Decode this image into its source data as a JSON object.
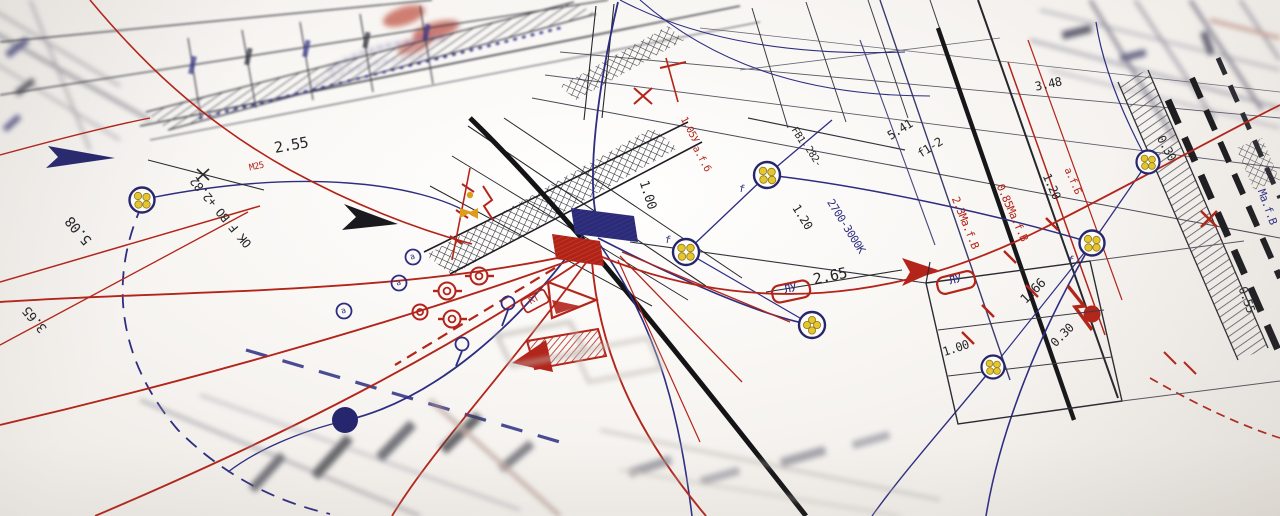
{
  "scene": {
    "title": "electrical installation blueprint photo",
    "type": "technical-drawing-photograph"
  },
  "palette": {
    "paper": "#faf8f5",
    "ink": "#26262a",
    "red": "#b3241a",
    "navy": "#2d2d82",
    "yellow_dot": "#e6c62e",
    "orange": "#e09b18",
    "gray_line": "#6a6a72"
  },
  "symbols": {
    "circle_cluster": "cable-group-with-yellow-cores",
    "circled_letter": "а",
    "lightning": "fault-bolt",
    "hatched_band": "cable-tray-run"
  },
  "annotations": [
    {
      "text": "2.55",
      "x": 292,
      "y": 150,
      "rot": -10,
      "color": "ink",
      "size": 15,
      "name": "dimension-label"
    },
    {
      "text": "М25",
      "x": 257,
      "y": 169,
      "rot": -12,
      "color": "red",
      "size": 9,
      "name": "conduit-label"
    },
    {
      "text": "OK F BO +2.82",
      "x": 224,
      "y": 210,
      "rot": -130,
      "color": "ink",
      "size": 12,
      "name": "level-label"
    },
    {
      "text": "5.08",
      "x": 82,
      "y": 228,
      "rot": -130,
      "color": "ink",
      "size": 14,
      "name": "dimension-label"
    },
    {
      "text": "3.65",
      "x": 38,
      "y": 317,
      "rot": -130,
      "color": "ink",
      "size": 13,
      "name": "dimension-label"
    },
    {
      "text": "1.05У",
      "x": 687,
      "y": 131,
      "rot": 62,
      "color": "red",
      "size": 10,
      "name": "circuit-label"
    },
    {
      "text": "а.f.б",
      "x": 699,
      "y": 160,
      "rot": 62,
      "color": "red",
      "size": 10,
      "name": "circuit-label"
    },
    {
      "text": "1.00",
      "x": 644,
      "y": 196,
      "rot": 72,
      "color": "ink",
      "size": 13,
      "name": "dimension-label"
    },
    {
      "text": "f",
      "x": 741,
      "y": 192,
      "rot": 10,
      "color": "navy",
      "size": 10,
      "name": "phase-label"
    },
    {
      "text": "f",
      "x": 667,
      "y": 243,
      "rot": 10,
      "color": "navy",
      "size": 10,
      "name": "phase-label"
    },
    {
      "text": "f",
      "x": 1070,
      "y": 263,
      "rot": 10,
      "color": "navy",
      "size": 10,
      "name": "phase-label"
    },
    {
      "text": "FB1-",
      "x": 797,
      "y": 139,
      "rot": 58,
      "color": "ink",
      "size": 10,
      "name": "device-label"
    },
    {
      "text": "282-",
      "x": 811,
      "y": 158,
      "rot": 58,
      "color": "ink",
      "size": 10,
      "name": "device-label"
    },
    {
      "text": "1.20",
      "x": 799,
      "y": 219,
      "rot": 58,
      "color": "ink",
      "size": 12,
      "name": "dimension-label"
    },
    {
      "text": "2700-3000K",
      "x": 843,
      "y": 228,
      "rot": 58,
      "color": "navy",
      "size": 11,
      "name": "lamp-spec-label"
    },
    {
      "text": "2.65",
      "x": 831,
      "y": 281,
      "rot": -12,
      "color": "ink",
      "size": 15,
      "name": "dimension-label"
    },
    {
      "text": "ЛУ",
      "x": 791,
      "y": 292,
      "rot": -12,
      "color": "navy",
      "size": 11,
      "name": "junction-tag"
    },
    {
      "text": "ЛУ",
      "x": 956,
      "y": 283,
      "rot": -14,
      "color": "navy",
      "size": 11,
      "name": "junction-tag"
    },
    {
      "text": "5.41",
      "x": 902,
      "y": 133,
      "rot": -32,
      "color": "ink",
      "size": 12,
      "name": "dimension-label"
    },
    {
      "text": "f1-2",
      "x": 932,
      "y": 151,
      "rot": -32,
      "color": "ink",
      "size": 12,
      "name": "phase-label"
    },
    {
      "text": "2.3Ма.f.В",
      "x": 962,
      "y": 224,
      "rot": 68,
      "color": "red",
      "size": 11,
      "name": "cable-spec-label"
    },
    {
      "text": "0.85Ма.f.В",
      "x": 1009,
      "y": 214,
      "rot": 66,
      "color": "red",
      "size": 11,
      "name": "cable-spec-label"
    },
    {
      "text": "1.20",
      "x": 1048,
      "y": 188,
      "rot": 66,
      "color": "ink",
      "size": 12,
      "name": "dimension-label"
    },
    {
      "text": "а.f.Б",
      "x": 1070,
      "y": 182,
      "rot": 66,
      "color": "red",
      "size": 10,
      "name": "cable-spec-label"
    },
    {
      "text": "3.48",
      "x": 1049,
      "y": 88,
      "rot": -12,
      "color": "ink",
      "size": 12,
      "name": "dimension-label"
    },
    {
      "text": "0.30",
      "x": 1163,
      "y": 150,
      "rot": 62,
      "color": "ink",
      "size": 12,
      "name": "dimension-label"
    },
    {
      "text": "0.55",
      "x": 1243,
      "y": 301,
      "rot": 70,
      "color": "ink",
      "size": 12,
      "name": "dimension-label"
    },
    {
      "text": "Ма.f.В",
      "x": 1264,
      "y": 208,
      "rot": 70,
      "color": "navy",
      "size": 11,
      "name": "cable-spec-label"
    },
    {
      "text": "1.66",
      "x": 1036,
      "y": 294,
      "rot": -45,
      "color": "ink",
      "size": 13,
      "name": "dimension-label"
    },
    {
      "text": "0.30",
      "x": 1065,
      "y": 338,
      "rot": -45,
      "color": "ink",
      "size": 12,
      "name": "dimension-label"
    },
    {
      "text": "1.00",
      "x": 957,
      "y": 352,
      "rot": -18,
      "color": "ink",
      "size": 12,
      "name": "dimension-label"
    },
    {
      "text": "RT",
      "x": 535,
      "y": 302,
      "rot": -28,
      "color": "red",
      "size": 9,
      "name": "device-tag"
    },
    {
      "text": "а",
      "x": 413,
      "y": 259,
      "rot": -20,
      "color": "navy",
      "size": 8,
      "name": "circled-letter-symbol"
    },
    {
      "text": "а",
      "x": 399,
      "y": 285,
      "rot": -20,
      "color": "navy",
      "size": 8,
      "name": "circled-letter-symbol"
    },
    {
      "text": "а",
      "x": 344,
      "y": 313,
      "rot": -20,
      "color": "navy",
      "size": 8,
      "name": "circled-letter-symbol"
    }
  ]
}
